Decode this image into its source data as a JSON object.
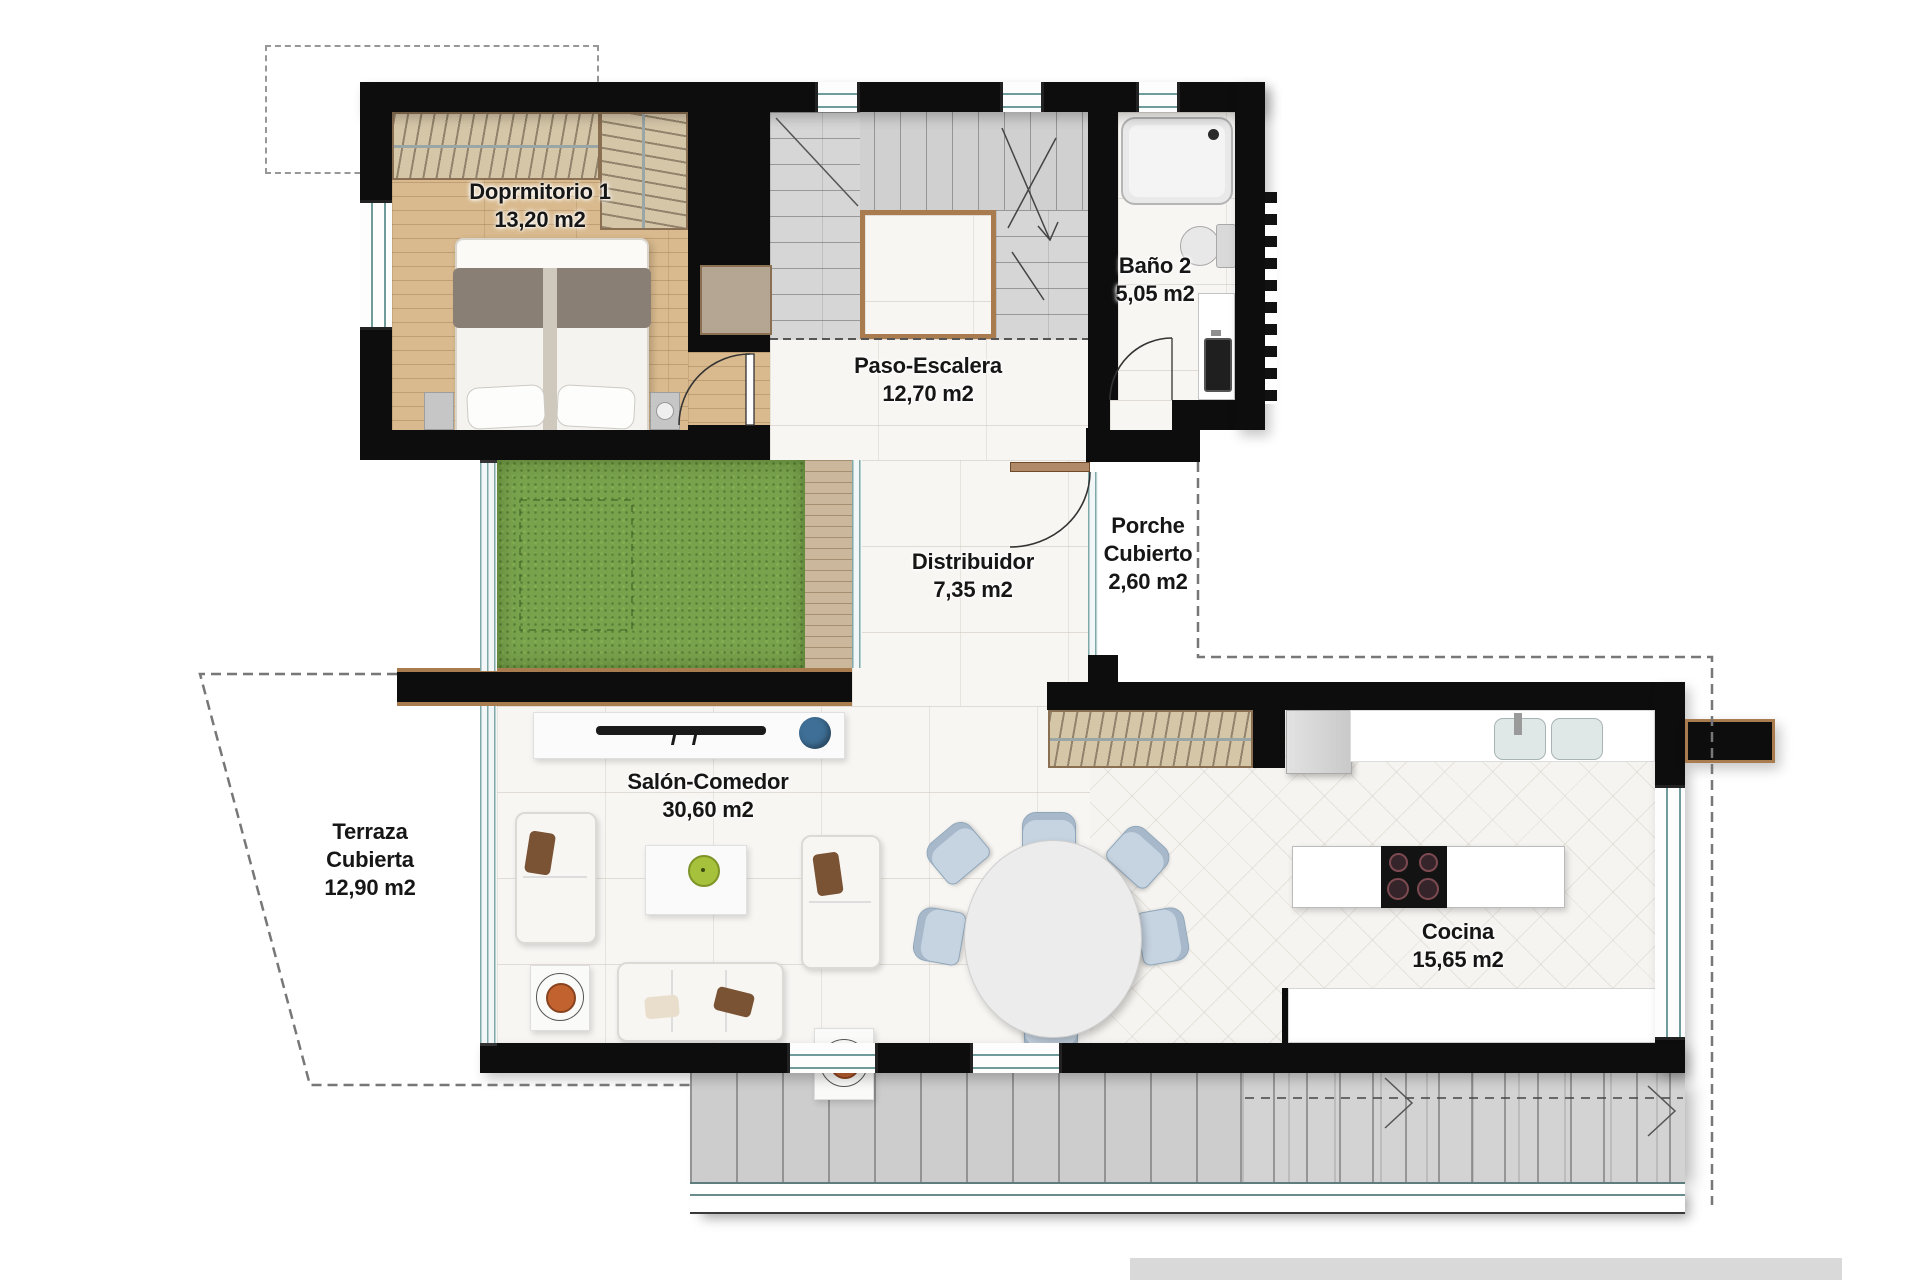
{
  "floorplan": {
    "rooms": {
      "dormitorio": {
        "name": "Doprmitorio 1",
        "area": "13,20 m2"
      },
      "bano": {
        "name": "Baño 2",
        "area": "5,05 m2"
      },
      "paso_escalera": {
        "name": "Paso-Escalera",
        "area": "12,70 m2"
      },
      "distribuidor": {
        "name": "Distribuidor",
        "area": "7,35 m2"
      },
      "porche_cubierto": {
        "name_line1": "Porche",
        "name_line2": "Cubierto",
        "area": "2,60 m2"
      },
      "terraza_cubierta": {
        "name_line1": "Terraza",
        "name_line2": "Cubierta",
        "area": "12,90 m2"
      },
      "salon_comedor": {
        "name": "Salón-Comedor",
        "area": "30,60 m2"
      },
      "cocina": {
        "name": "Cocina",
        "area": "15,65 m2"
      }
    },
    "colors": {
      "wall": "#0d0d0d",
      "wood_floor": "#d9ba8e",
      "marble_floor": "#f8f6f3",
      "stairs_tile": "#d6d6d6",
      "grass": "#79a24d",
      "deck_wood": "#cbb79b",
      "terrace_concrete": "#cdcdcd",
      "window_frame": "#7fa8a8",
      "door_wood": "#a97c50",
      "closet_beige": "#d6c6a8",
      "dining_chair_blue": "#c6d4e2",
      "bowl_green": "#a6c23c",
      "bowl_blue": "#3f6f96",
      "cushion_orange": "#c2622f",
      "footer_strip": "#d9d9d9"
    }
  }
}
